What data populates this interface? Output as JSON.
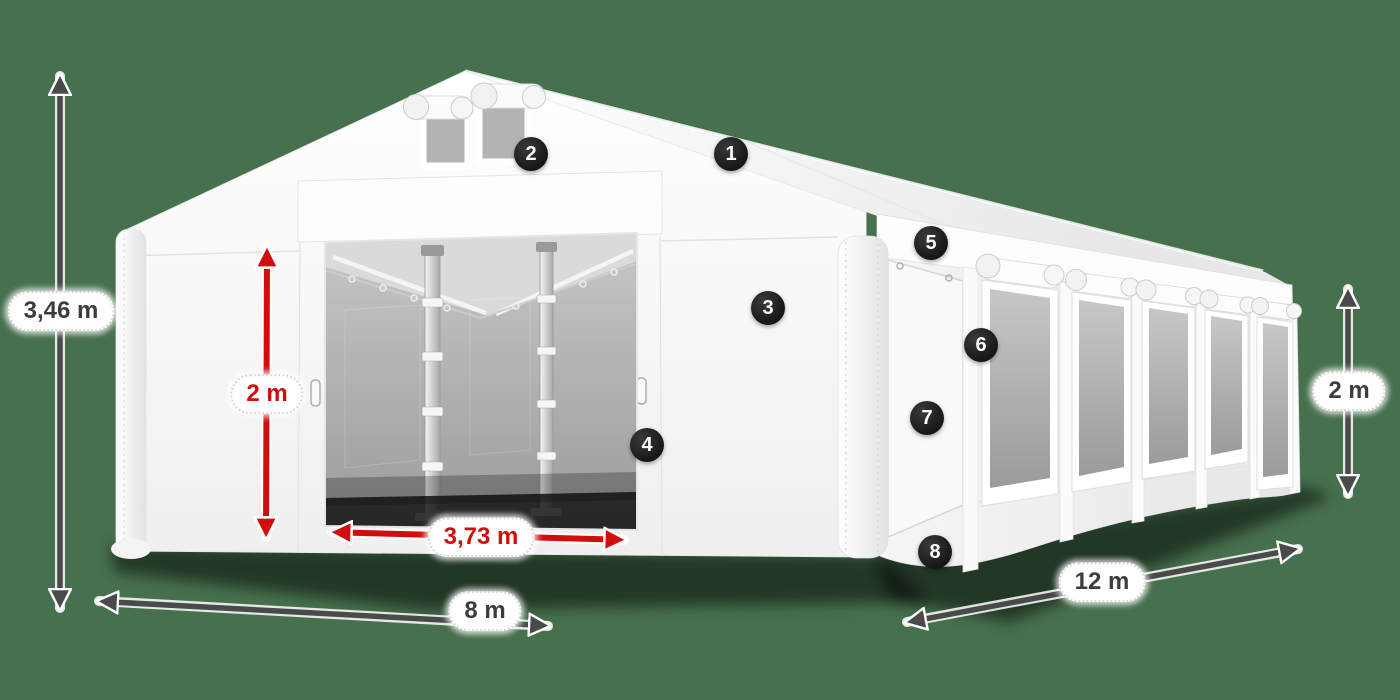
{
  "scene": {
    "description": "Storage tent dimension diagram with numbered feature markers",
    "colors": {
      "background": "#47704E",
      "accent_red": "#d10e0e",
      "dimension_gray": "#4a4a4a",
      "marker_bg": "#1d1d1d",
      "tent_white": "#f5f5f5"
    }
  },
  "dimensions": {
    "total_height": "3,46 m",
    "door_height": "2 m",
    "door_width": "3,73 m",
    "front_width": "8 m",
    "side_length": "12 m",
    "wall_height": "2 m"
  },
  "markers": [
    {
      "number": "1"
    },
    {
      "number": "2"
    },
    {
      "number": "3"
    },
    {
      "number": "4"
    },
    {
      "number": "5"
    },
    {
      "number": "6"
    },
    {
      "number": "7"
    },
    {
      "number": "8"
    }
  ]
}
